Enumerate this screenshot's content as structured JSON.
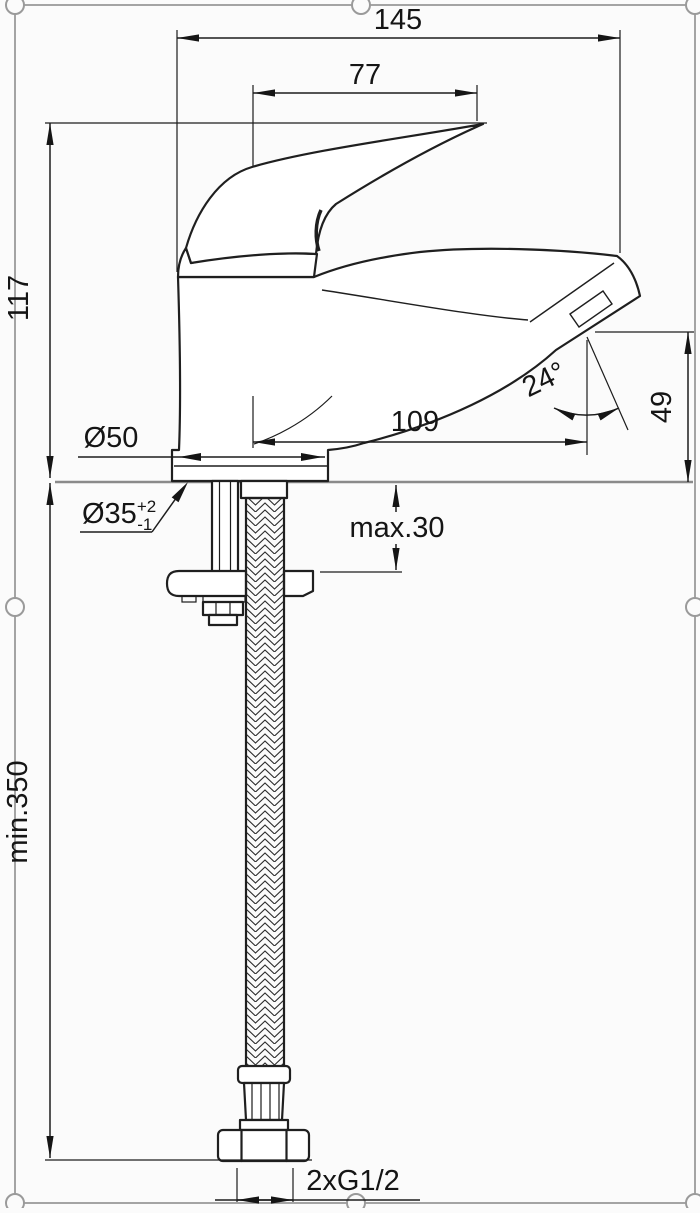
{
  "drawing": {
    "type": "technical-dimension-drawing",
    "subject": "single-lever basin mixer tap with flexible supply hose",
    "colors": {
      "background": "#fbfbfb",
      "line": "#1f1f1f",
      "sheet_border": "#9a9a9a",
      "counter_line": "#8a8a8a"
    },
    "labels": {
      "total_width": "145",
      "lever_width": "77",
      "height_above_deck": "117",
      "base_diameter": "Ø50",
      "hole_diameter": "Ø35",
      "hole_tol_plus": "+2",
      "hole_tol_minus": "-1",
      "spout_reach": "109",
      "outlet_angle": "24°",
      "outlet_height": "49",
      "max_deck_thickness": "max.30",
      "min_hose_length": "min.350",
      "thread_connection": "2xG1/2"
    }
  }
}
